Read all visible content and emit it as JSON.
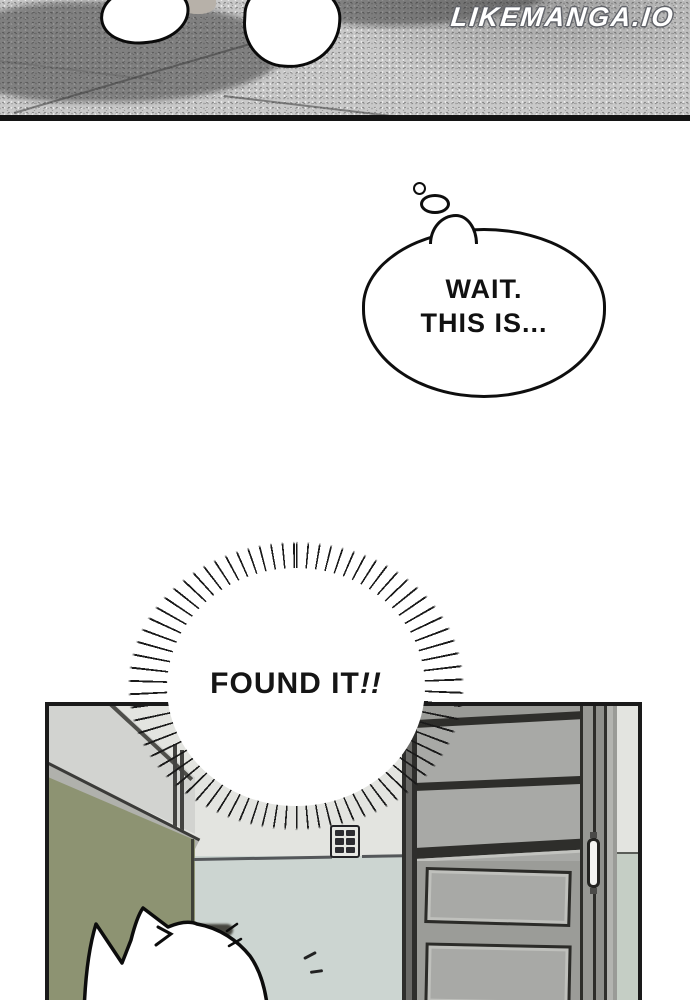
{
  "watermark": {
    "text": "LIKEMANGA.IO"
  },
  "thought_bubble": {
    "line1": "WAIT.",
    "line2": "THIS IS..."
  },
  "burst": {
    "text": "FOUND IT",
    "emphasis": "!!"
  },
  "colors": {
    "floor_light": "#c9c9c9",
    "floor_shadow": "#8e8e8e",
    "olive_wall": "#8d9372",
    "wall_upper": "#e3e4e0",
    "wall_lower": "#ccd5d1",
    "glass": "#d2d3d0",
    "sill": "#b0b1ac",
    "door_panel": "#a8a9a6",
    "door_stile": "#9b9c98",
    "door_rail": "#2e2e2b",
    "wall_strip_lower": "#c5cec5",
    "ink": "#0e0e0e"
  }
}
